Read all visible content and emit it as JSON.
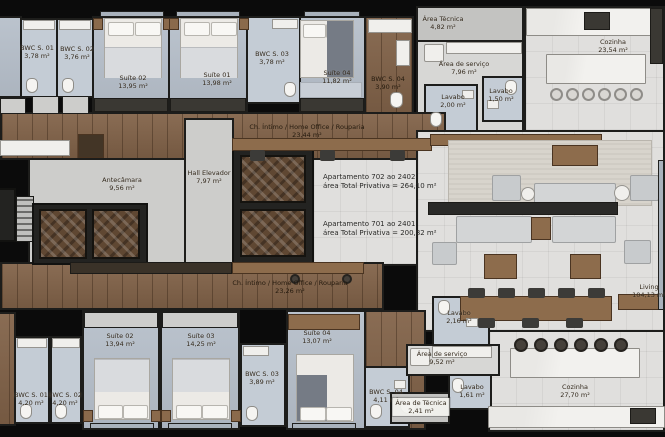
{
  "plan": {
    "title": "Planta do pavimento tipo",
    "units": [
      {
        "name": "Apartamento 702 ao 2402",
        "area_line": "área Total Privativa = 264,10 m²"
      },
      {
        "name": "Apartamento 701 ao 2401",
        "area_line": "área Total Privativa = 200,82 m²"
      }
    ],
    "rooms": [
      {
        "name": "BWC S. 01",
        "area": "3,78 m²"
      },
      {
        "name": "BWC S. 02",
        "area": "3,76 m²"
      },
      {
        "name": "Suíte 02",
        "area": "13,95 m²"
      },
      {
        "name": "Suíte 01",
        "area": "13,98 m²"
      },
      {
        "name": "BWC S. 03",
        "area": "3,78 m²"
      },
      {
        "name": "Suíte 04",
        "area": "11,82 m²"
      },
      {
        "name": "BWC S. 04",
        "area": "3,90 m²"
      },
      {
        "name": "Área Técnica",
        "area": "4,82 m²"
      },
      {
        "name": "Área de serviço",
        "area": "7,96 m²"
      },
      {
        "name": "Lavabo",
        "area": "2,00 m²"
      },
      {
        "name": "Lavabo",
        "area": "1,50 m²"
      },
      {
        "name": "Cozinha",
        "area": "23,54 m²"
      },
      {
        "name": "Ch. Íntimo / Home Office / Rouparia",
        "area": "23,44 m²"
      },
      {
        "name": "Hall Elevador",
        "area": "7,97 m²"
      },
      {
        "name": "Antecâmara",
        "area": "9,56 m²"
      },
      {
        "name": "Ch. Íntimo / Home Office / Rouparia",
        "area": "23,26 m²"
      },
      {
        "name": "Suíte 02",
        "area": "13,94 m²"
      },
      {
        "name": "Suíte 03",
        "area": "14,25 m²"
      },
      {
        "name": "Suíte 04",
        "area": "13,07 m²"
      },
      {
        "name": "BWC S. 01",
        "area": "4,20 m²"
      },
      {
        "name": "BWC S. 02",
        "area": "4,20 m²"
      },
      {
        "name": "BWC S. 03",
        "area": "3,89 m²"
      },
      {
        "name": "BWC S. 04",
        "area": "4,11 m²"
      },
      {
        "name": "Lavabo",
        "area": "2,16 m²"
      },
      {
        "name": "Área de serviço",
        "area": "9,52 m²"
      },
      {
        "name": "Lavabo",
        "area": "1,61 m²"
      },
      {
        "name": "Área de Técnica",
        "area": "2,41 m²"
      },
      {
        "name": "Cozinha",
        "area": "27,70 m²"
      },
      {
        "name": "Living",
        "area": "104,13 m²"
      }
    ],
    "colors": {
      "wall": "#1d1d1b",
      "wood_floor": "#826349",
      "tile_floor": "#e0dfdd",
      "bedroom_floor": "#b5bec9",
      "label_text": "#33291c"
    }
  }
}
